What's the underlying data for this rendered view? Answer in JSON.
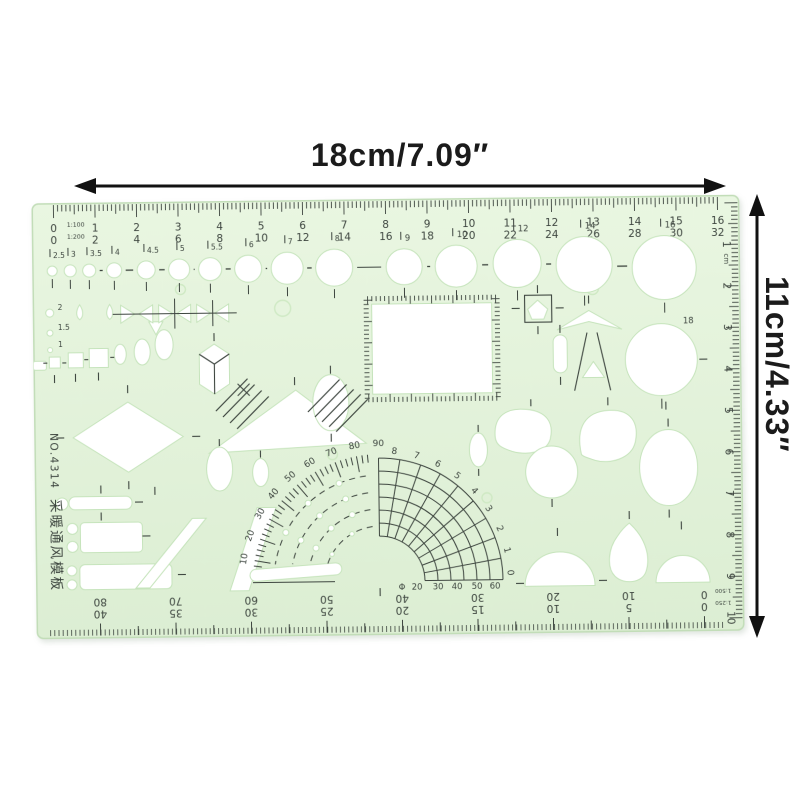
{
  "photo": {
    "width_label": "18cm/7.09″",
    "height_label": "11cm/4.33″",
    "annotation_color": "#111111"
  },
  "stencil": {
    "model": "NO.4314",
    "chinese_title": "采暖通风模板",
    "colors": {
      "body": "#e3f1da",
      "cutout": "#ffffff",
      "marking": "#3d453f",
      "edge": "#c2ddb8"
    },
    "top_ruler": {
      "scales": [
        "1:100",
        "1:200"
      ],
      "row_1_100": [
        "0",
        "1",
        "2",
        "3",
        "4",
        "5",
        "6",
        "7",
        "8",
        "9",
        "10",
        "11",
        "12",
        "13",
        "14",
        "15",
        "16"
      ],
      "row_1_200": [
        "0",
        "2",
        "4",
        "6",
        "8",
        "10",
        "12",
        "14",
        "16",
        "18",
        "20",
        "22",
        "24",
        "26",
        "28",
        "30",
        "32"
      ]
    },
    "right_ruler": {
      "unit": "cm",
      "values": [
        "1",
        "2",
        "3",
        "4",
        "5",
        "6",
        "7",
        "8",
        "9",
        "10"
      ]
    },
    "bottom_ruler": {
      "scales": [
        "1:500",
        "1:250"
      ],
      "row_1_500": [
        "0",
        "10",
        "20",
        "30",
        "40",
        "50",
        "60",
        "70",
        "80"
      ],
      "row_1_250": [
        "0",
        "5",
        "10",
        "15",
        "20",
        "25",
        "30",
        "35",
        "40"
      ]
    },
    "circle_diameters_mm": {
      "small_row": [
        "2.5",
        "3",
        "3.5",
        "4",
        "4.5",
        "5",
        "5.5",
        "6",
        "7",
        "8"
      ],
      "large": [
        "9",
        "10",
        "12",
        "14",
        "16",
        "18"
      ],
      "side_column": [
        "2",
        "1.5",
        "1"
      ]
    },
    "protractor": {
      "degrees": [
        "10",
        "20",
        "30",
        "40",
        "50",
        "60",
        "70",
        "80",
        "90"
      ],
      "grid": [
        "8",
        "7",
        "6",
        "5",
        "4",
        "3",
        "2",
        "1",
        "0"
      ],
      "phi": "Φ",
      "diameters": [
        "20",
        "30",
        "40",
        "50",
        "60"
      ]
    }
  }
}
